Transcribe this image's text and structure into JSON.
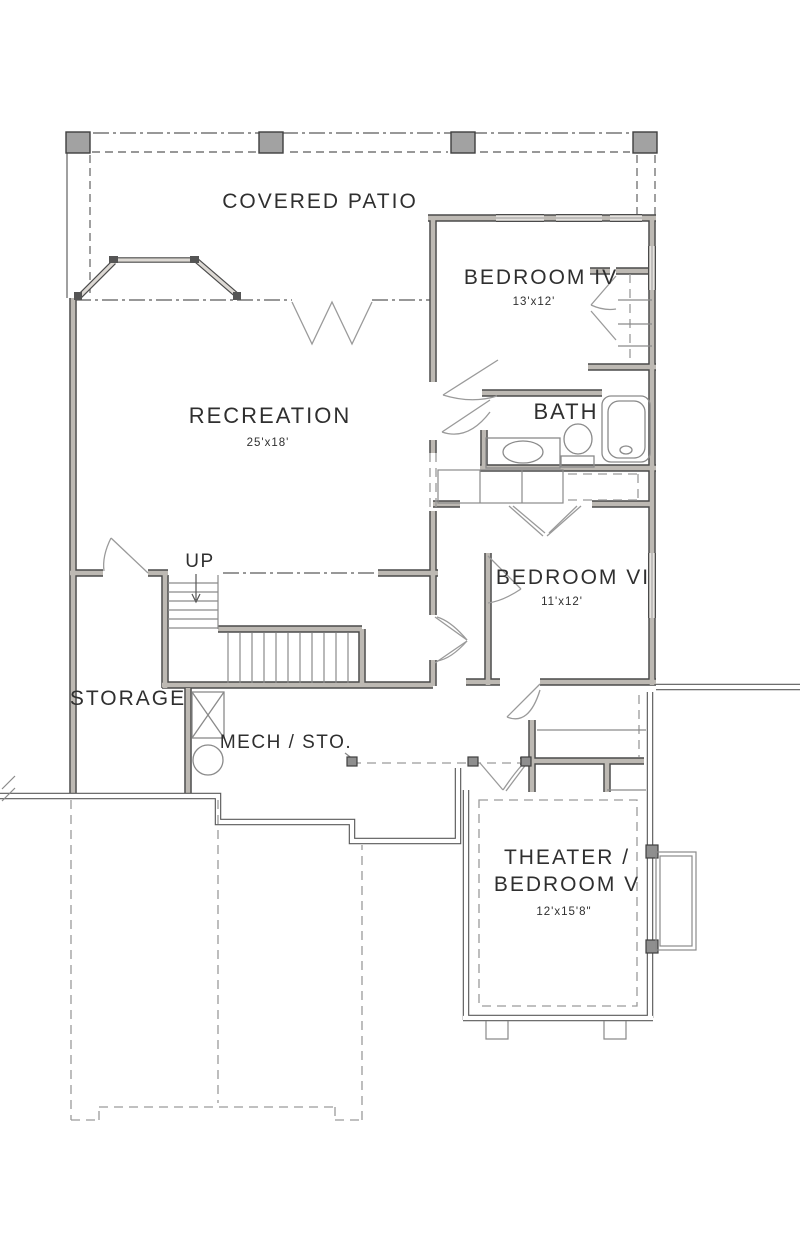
{
  "plan": {
    "type": "floor-plan",
    "rooms": {
      "covered_patio": {
        "label": "COVERED PATIO"
      },
      "bedroom4": {
        "label": "BEDROOM IV",
        "dims": "13'x12'"
      },
      "recreation": {
        "label": "RECREATION",
        "dims": "25'x18'"
      },
      "bath": {
        "label": "BATH"
      },
      "bedroom6": {
        "label": "BEDROOM VI",
        "dims": "11'x12'"
      },
      "storage": {
        "label": "STORAGE"
      },
      "mech": {
        "label": "MECH / STO."
      },
      "stairs": {
        "label": "UP"
      },
      "theater": {
        "label_line1": "THEATER /",
        "label_line2": "BEDROOM V",
        "dims": "12'x15'8\""
      }
    },
    "colors": {
      "wall_edge": "#4a4a4a",
      "wall_fill": "#bdb9b3",
      "thin_line": "#8a8a8a",
      "text": "#2f2f2f",
      "background": "#ffffff"
    }
  }
}
